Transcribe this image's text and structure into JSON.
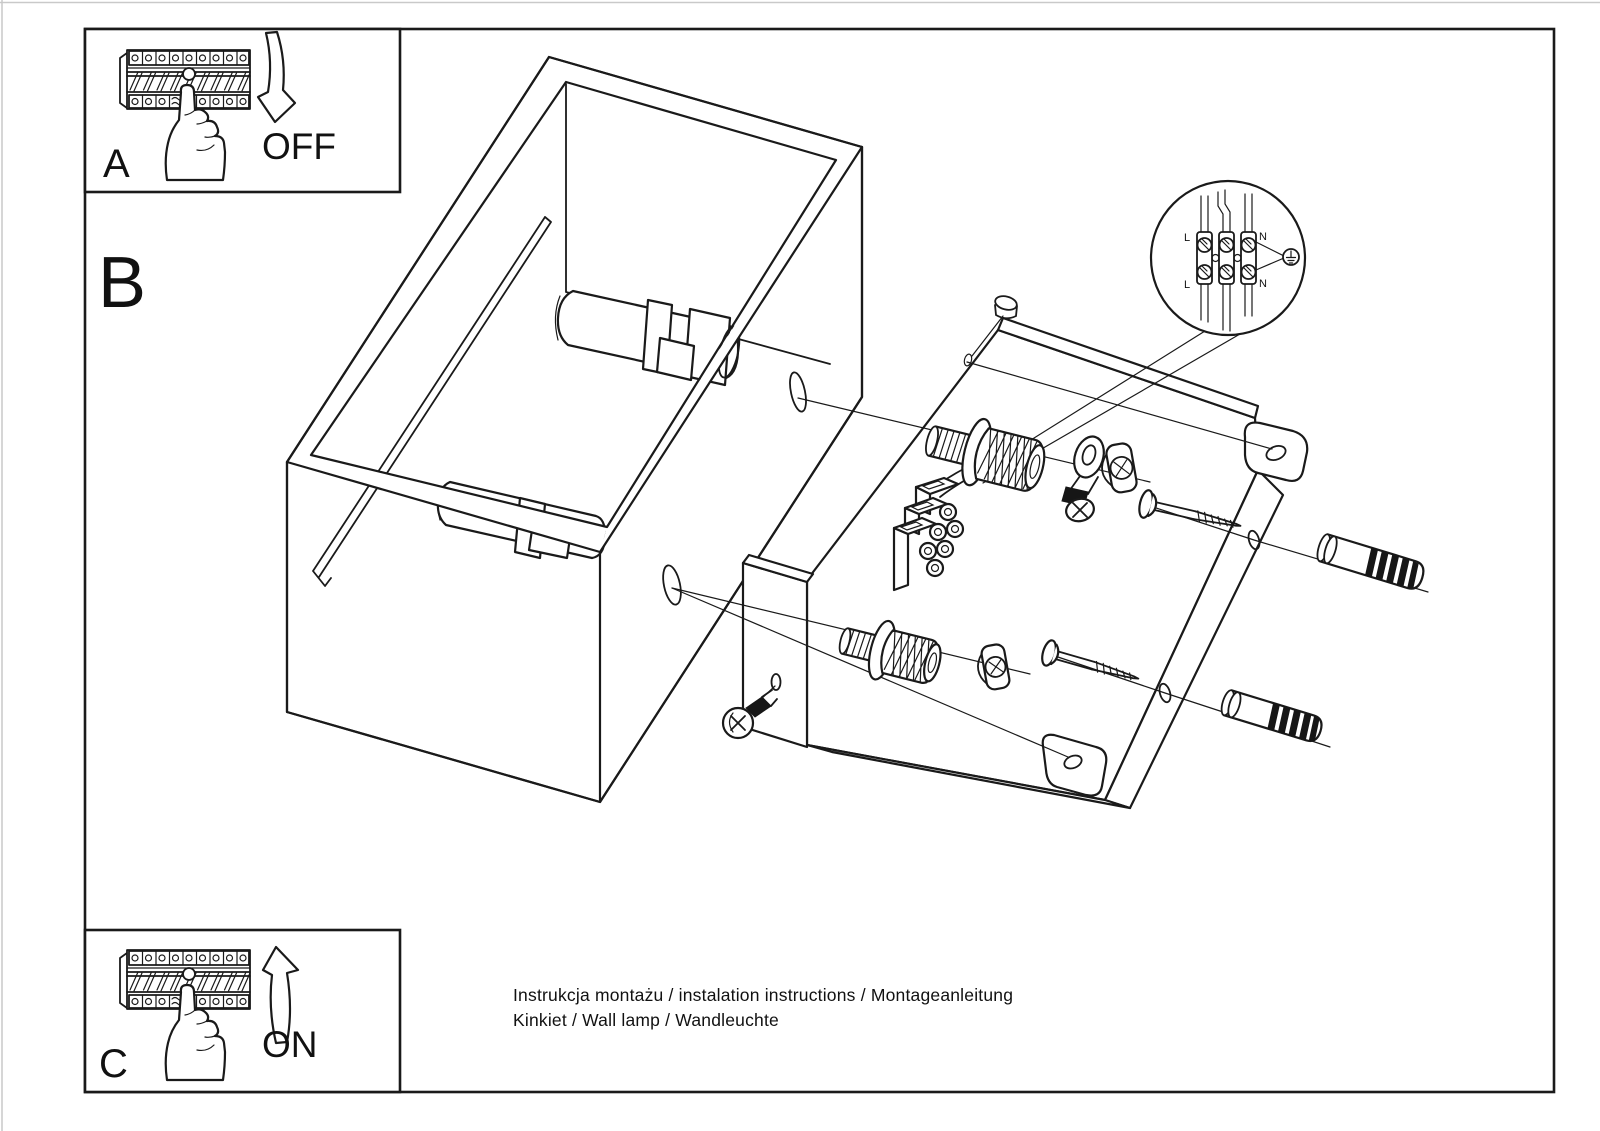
{
  "document": {
    "type": "installation-instruction-sheet",
    "product": "wall lamp",
    "colors": {
      "ink": "#1a1a1a",
      "paper": "#ffffff",
      "dark_fill": "#161616"
    }
  },
  "steps": {
    "a": {
      "label": "A",
      "action": "OFF"
    },
    "b": {
      "label": "B"
    },
    "c": {
      "label": "C",
      "action": "ON"
    }
  },
  "wiring_detail": {
    "labels": {
      "top_left": "L",
      "top_right": "N",
      "bottom_left": "L",
      "bottom_right": "N"
    }
  },
  "footer": {
    "line1": "Instrukcja montażu / instalation instructions / Montageanleitung",
    "line2": "Kinkiet / Wall lamp / Wandleuchte"
  }
}
